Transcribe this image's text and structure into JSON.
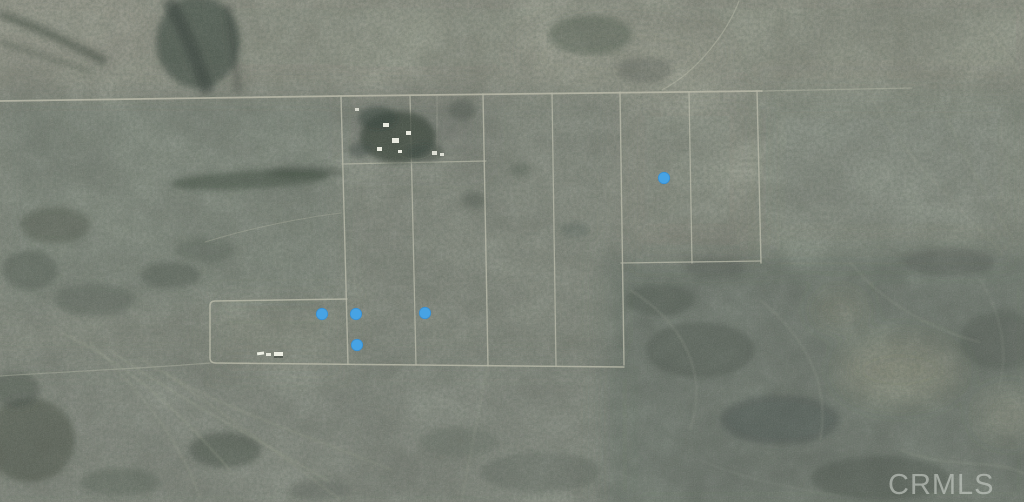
{
  "watermark": {
    "text": "CRMLS",
    "color": "#cdd2cc",
    "opacity": 0.6
  },
  "map": {
    "marker_color": "#47a3e4",
    "marker_edge_color": "#3b8fd0",
    "marker_radius": 5.7,
    "markers": [
      {
        "x": 322,
        "y": 314
      },
      {
        "x": 356,
        "y": 314
      },
      {
        "x": 425,
        "y": 313
      },
      {
        "x": 357,
        "y": 345
      },
      {
        "x": 664,
        "y": 178
      }
    ]
  }
}
